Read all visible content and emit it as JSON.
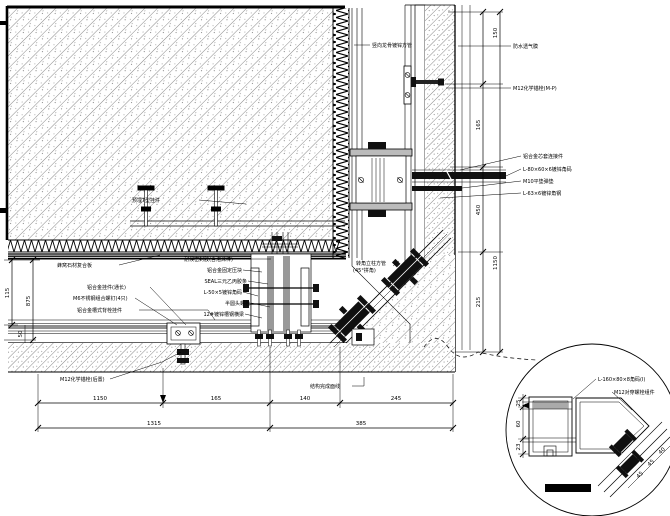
{
  "colors": {
    "line": "#000000",
    "gray_plate": "#8a8a8a",
    "hatch_dot": "#666666",
    "assembly_fill": "#101010"
  },
  "labels": {
    "top_mullion": "竖向龙骨镀锌方管",
    "slab_hanger": "预埋T型挂件",
    "left": [
      "蜂窝石材复合板",
      "铝合金挂件(通长)",
      "M6不锈钢组合螺钉(4只)",
      "铝合金槽式背栓挂件"
    ],
    "center": [
      "耐候密封胶(含泡沫棒)",
      "铝合金固定压块",
      "SEAL三元乙丙胶条",
      "L-50×5镀锌角码",
      "半圆头螺栓",
      "12#镀锌槽钢横梁"
    ],
    "corner_line1": "转角立柱方管",
    "corner_line2": "(45°拼角)",
    "anchor_bottom": "M12化学锚栓(后置)",
    "floor_line": "结构完成面线",
    "right_top": [
      "防水透气膜",
      "M12化学锚栓(M-P)"
    ],
    "right_mid": [
      "铝合金芯套连接件",
      "L-80×60×6镀锌角码",
      "M10平垫弹垫",
      "L-63×6镀锌角钢"
    ],
    "detail": [
      "L-160×80×8角码(Ⅰ)",
      "M12对穿螺栓组件"
    ]
  },
  "dims": {
    "bottom_row1": [
      "1150",
      "165",
      "140",
      "245"
    ],
    "bottom_row2": [
      "1315",
      "385"
    ],
    "right_inner": [
      "165",
      "450",
      "215"
    ],
    "right_outer": [
      "150",
      "1150"
    ],
    "left_inner": "115",
    "left_outer": "875",
    "left_small": "50",
    "detail_left": [
      "25",
      "60",
      "23"
    ],
    "detail_diag": [
      "45",
      "45",
      "40"
    ]
  }
}
